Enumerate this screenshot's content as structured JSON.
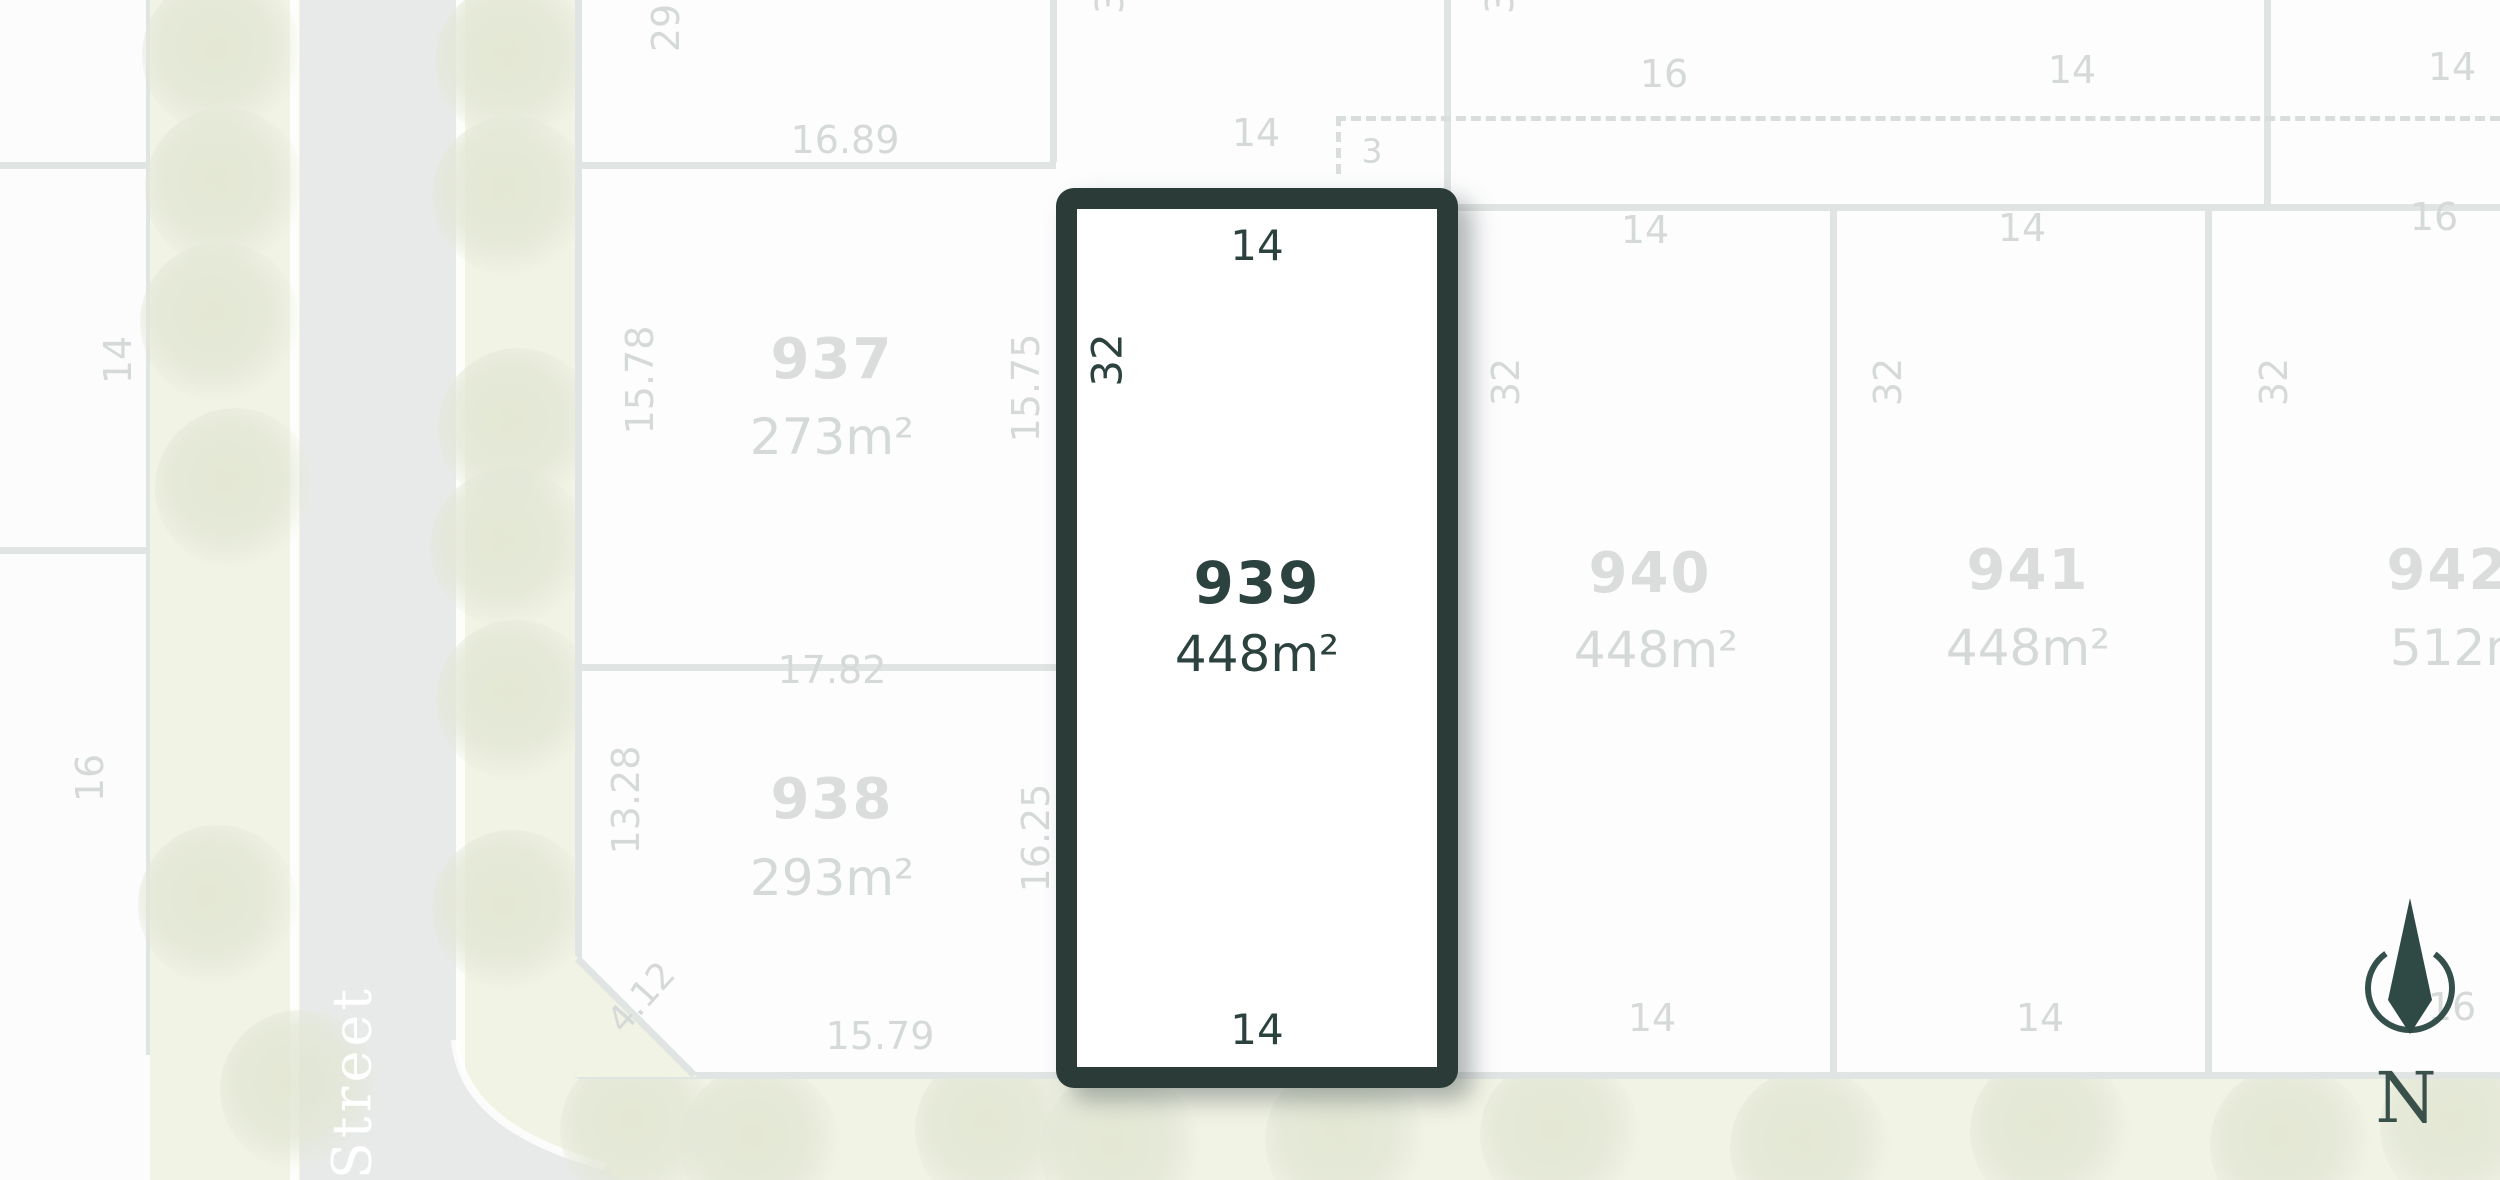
{
  "colors": {
    "accent_dark": "#2b3c38",
    "accent_dark_text": "#2c423e",
    "muted_label": "#d5d9d7",
    "boundary_line": "#e0e4e2",
    "street_fill": "#e8eae9",
    "verge_fill": "#f1f3e4",
    "tree_fill": "#e3e7d6"
  },
  "street": {
    "name": "Street"
  },
  "compass": {
    "north_label": "N"
  },
  "highlighted_lot": {
    "number": "939",
    "area": "448m²",
    "dim_top": "14",
    "dim_side": "32",
    "dim_bottom": "14"
  },
  "lots": {
    "l937": {
      "number": "937",
      "area": "273m²",
      "dim_top": "16.89",
      "dim_left": "15.78",
      "dim_right": "15.75"
    },
    "l938": {
      "number": "938",
      "area": "293m²",
      "dim_top": "17.82",
      "dim_left": "13.28",
      "dim_right": "16.25",
      "dim_bottom": "15.79",
      "dim_splay": "4.12"
    },
    "l940": {
      "number": "940",
      "area": "448m²",
      "dim_top": "14",
      "dim_side": "32",
      "dim_bottom": "14"
    },
    "l941": {
      "number": "941",
      "area": "448m²",
      "dim_top": "14",
      "dim_side": "32",
      "dim_bottom": "14"
    },
    "l942": {
      "number": "942",
      "area": "512m²",
      "dim_top": "16",
      "dim_side": "32",
      "dim_bottom": "16"
    }
  },
  "west_lots": {
    "dim_upper": "14",
    "dim_lower": "16"
  },
  "top_row": {
    "dim_side_cut": "29",
    "dim_cut_a": "3",
    "dim_cut_b": "3",
    "offset_dim": "3",
    "dim_a": "14",
    "dim_b": "16",
    "dim_c": "14",
    "dim_d": "14"
  }
}
